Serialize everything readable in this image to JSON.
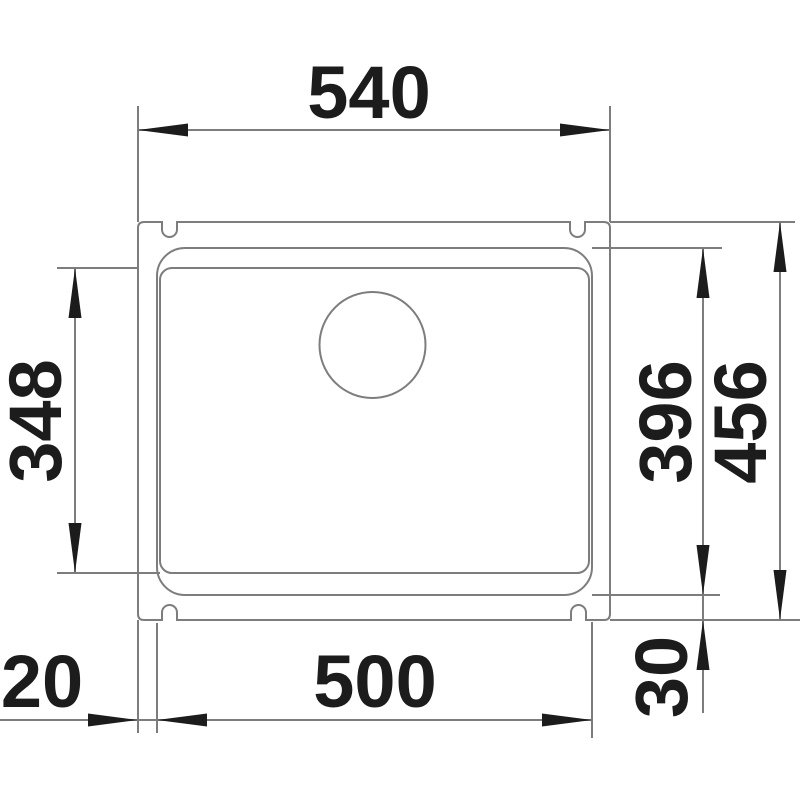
{
  "diagram": {
    "type": "technical-dimension-drawing",
    "subject": "undermount kitchen sink, top view with installation dimensions",
    "units": "mm",
    "colors": {
      "background": "#ffffff",
      "drawing_line": "#7d7d7d",
      "ink": "#1c1c1c"
    },
    "parts": [
      "outer-rim-with-fastening-notches",
      "basin-rim",
      "basin-floor",
      "drain-hole"
    ],
    "dimensions": {
      "overall_width": {
        "value": "540",
        "orientation": "horizontal",
        "position": "top"
      },
      "basin_floor_depth": {
        "value": "348",
        "orientation": "vertical",
        "position": "left"
      },
      "basin_depth": {
        "value": "396",
        "orientation": "vertical",
        "position": "right-inner"
      },
      "overall_depth": {
        "value": "456",
        "orientation": "vertical",
        "position": "right-outer"
      },
      "left_rim_offset": {
        "value": "20",
        "orientation": "horizontal",
        "position": "bottom-left"
      },
      "basin_width": {
        "value": "500",
        "orientation": "horizontal",
        "position": "bottom"
      },
      "bottom_rim_offset": {
        "value": "30",
        "orientation": "vertical",
        "position": "bottom-right"
      }
    }
  }
}
